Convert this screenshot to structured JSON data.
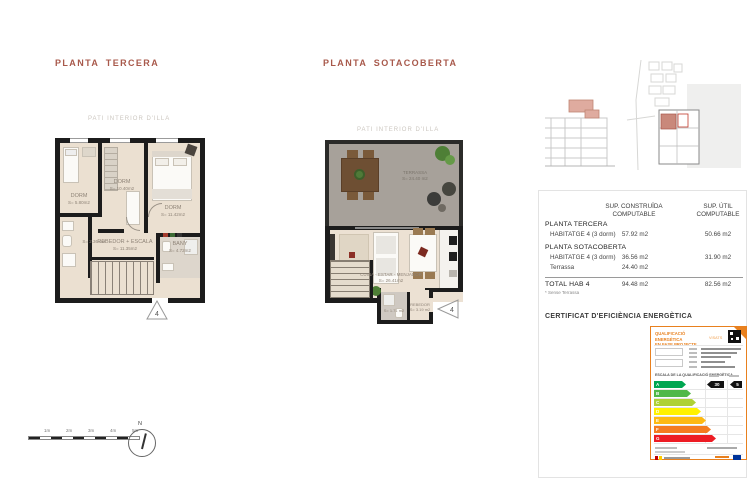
{
  "colors": {
    "accent_title": "#a8594b",
    "wall": "#1c1c1c",
    "floor": "#ebe0d1",
    "terrace": "#a7a19a",
    "highlight_pink": "#d9a69b",
    "cert_orange": "#e8801e"
  },
  "plans": {
    "tercera": {
      "title": "PLANTA  TERCERA",
      "context_label": "PATI INTERIOR D'ILLA",
      "rooms": [
        {
          "name": "DORM",
          "area": "S= 5.80m2"
        },
        {
          "name": "DORM",
          "area": "S= 10.40m2"
        },
        {
          "name": "DORM",
          "area": "S= 11.42m2"
        },
        {
          "name": "BANY",
          "area": "S= 4.72m2"
        },
        {
          "name": "",
          "area": "S= 2.36 m2"
        },
        {
          "name": "REBEDOR + ESCALA",
          "area": "S= 11.35m2"
        }
      ],
      "unit_marker": "4"
    },
    "sotacoberta": {
      "title": "PLANTA SOTACOBERTA",
      "context_label": "PATI INTERIOR D'ILLA",
      "rooms": [
        {
          "name": "TERRASSA",
          "area": "S= 24.40 m2"
        },
        {
          "name": "CUINA - ESTAR - MENJADOR",
          "area": "S= 26.41m2"
        },
        {
          "name": "REBEDOR",
          "area": "S= 3.19 m2"
        },
        {
          "name": "",
          "area": "S= 1.71 m2"
        }
      ],
      "unit_marker": "4"
    }
  },
  "area_table": {
    "col_headers": [
      "SUP. CONSTRUÏDA\nCOMPUTABLE",
      "SUP. ÚTIL\nCOMPUTABLE"
    ],
    "groups": [
      {
        "section": "PLANTA TERCERA",
        "rows": [
          {
            "label": "HABITATGE 4   (3 dorm)",
            "built": "57.92 m2",
            "useful": "50.66 m2"
          }
        ]
      },
      {
        "section": "PLANTA SOTACOBERTA",
        "rows": [
          {
            "label": "HABITATGE 4   (3 dorm)",
            "built": "36.56 m2",
            "useful": "31.90 m2"
          },
          {
            "label": "Terrassa",
            "built": "24.40 m2",
            "useful": ""
          }
        ]
      }
    ],
    "total": {
      "label": "TOTAL HAB 4",
      "built": "94.48 m2",
      "useful": "82.56 m2"
    },
    "footnote": "* Sense Terrassa"
  },
  "certificate": {
    "section_title": "CERTIFICAT D'EFICIÈNCIA ENERGÈTICA",
    "header": "QUALIFICACIÓ ENERGÈTICA\nEN FASE PROJECTE",
    "header_tag": "VISATS",
    "scale_title": "ESCALA DE LA QUALIFICACIÓ ENERGÈTICA",
    "scale": [
      {
        "letter": "A",
        "color": "#00a651"
      },
      {
        "letter": "B",
        "color": "#50b848"
      },
      {
        "letter": "C",
        "color": "#aed136"
      },
      {
        "letter": "D",
        "color": "#fff200"
      },
      {
        "letter": "E",
        "color": "#fdb913"
      },
      {
        "letter": "F",
        "color": "#f47b20"
      },
      {
        "letter": "G",
        "color": "#ed1c24"
      }
    ],
    "rating_letter": "A",
    "indicators": [
      {
        "value": "30"
      },
      {
        "value": "5"
      }
    ]
  },
  "scale_bar": {
    "labels": [
      "1m",
      "2m",
      "3m",
      "4m",
      "5m"
    ]
  },
  "compass": {
    "label": "N"
  }
}
